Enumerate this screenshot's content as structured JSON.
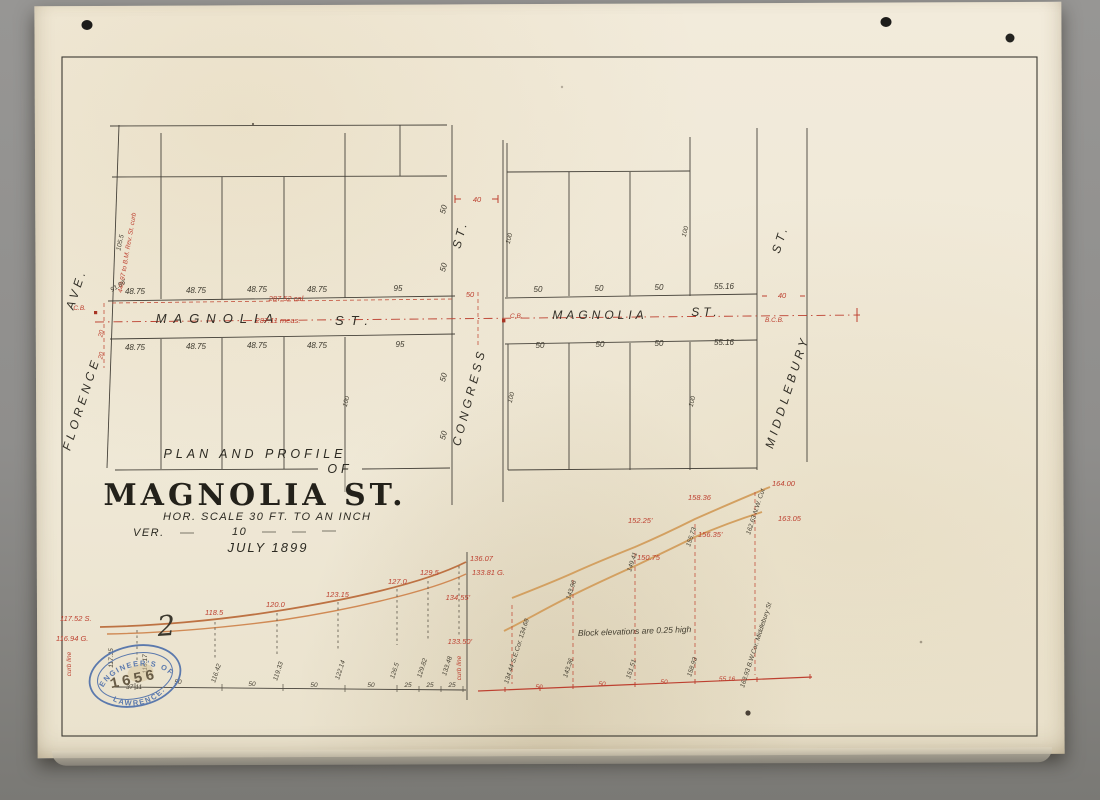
{
  "title_block": {
    "line1": "PLAN AND PROFILE",
    "line2": "OF",
    "street": "MAGNOLIA ST.",
    "h_scale": "HOR. SCALE 30 FT. TO AN INCH",
    "ver_label": "VER.",
    "ver_value": "10",
    "date": "JULY 1899"
  },
  "stamp": {
    "arc_top": "CITY ENGINEER'S OFFICE",
    "number": "1656",
    "arc_bottom": "LAWRENCE.",
    "ref": "37-11"
  },
  "plan": {
    "streets": {
      "magnolia_w": "MAGNOLIA",
      "magnolia_w_st": "ST.",
      "magnolia_e": "MAGNOLIA",
      "magnolia_e_st": "ST.",
      "congress": "CONGRESS",
      "congress_st": "ST.",
      "florence": "FLORENCE",
      "florence_ave": "AVE.",
      "middlebury": "MIDDLEBURY",
      "middlebury_st": "ST."
    },
    "lots_nw": [
      "48.75",
      "48.75",
      "48.75",
      "48.75",
      "95"
    ],
    "lots_sw": [
      "48.75",
      "48.75",
      "48.75",
      "48.75",
      "95"
    ],
    "lots_ne": [
      "50",
      "50",
      "50",
      "55.16"
    ],
    "lots_se": [
      "50",
      "50",
      "50",
      "55.16"
    ],
    "congress_frontage": [
      "50",
      "50",
      "50",
      "50"
    ],
    "depths": {
      "nw": "105.5",
      "sw": "100",
      "ne_w": "100",
      "ne_e": "100",
      "se_w": "100",
      "se_e": "100"
    },
    "red": {
      "bm_note": "448.97 to B.M. Rev. St. curb",
      "corner_dim": "91.96'",
      "calc": "287.52 cal.",
      "meas": "287.11 meas.",
      "cb_florence": "C.B.",
      "cb_congress": "C.B.",
      "bcb_middlebury": "B.C.B.",
      "florence_half_n": "20",
      "florence_half_s": "20",
      "congress_width": "40",
      "congress_fifty": "50",
      "middlebury_width": "40"
    }
  },
  "profile_w": {
    "start_top": "117.52 S.",
    "start_bottom": "116.94 G.",
    "grades": [
      "118.5",
      "120.0",
      "123.15",
      "127.0",
      "129.5"
    ],
    "end_top": "136.07",
    "end_bottom": "133.81 G.",
    "left_elev_a": "117.35",
    "left_elev_b": "116.17",
    "stations": [
      "116.42",
      "119.33",
      "122.14",
      "126.5",
      "129.82",
      "133.48"
    ],
    "spacings": [
      "50",
      "50",
      "50",
      "50",
      "25",
      "25",
      "25"
    ],
    "curb_left": "curb line",
    "curb_right": "curb line",
    "mark": "2"
  },
  "profile_e": {
    "start_top": "134.55'",
    "start_bottom": "133.50'",
    "corner_note": "134.44 S.E.Cor. 134.68",
    "top_grades": [
      "152.25'",
      "158.36",
      "164.00"
    ],
    "bottom_grades": [
      "150.75",
      "156.35'",
      "163.05"
    ],
    "mid_stations": [
      "143.96",
      "149.41",
      "155.73"
    ],
    "nw_cut": "162.63 N.W. Cut",
    "base_stations": [
      "143.36",
      "151.51",
      "158.93"
    ],
    "end_note": "163.93 B.W.Cor. Middlebury St",
    "note": "Block elevations are 0.25 high",
    "spacings": [
      "50",
      "50",
      "50",
      "55.16"
    ]
  }
}
